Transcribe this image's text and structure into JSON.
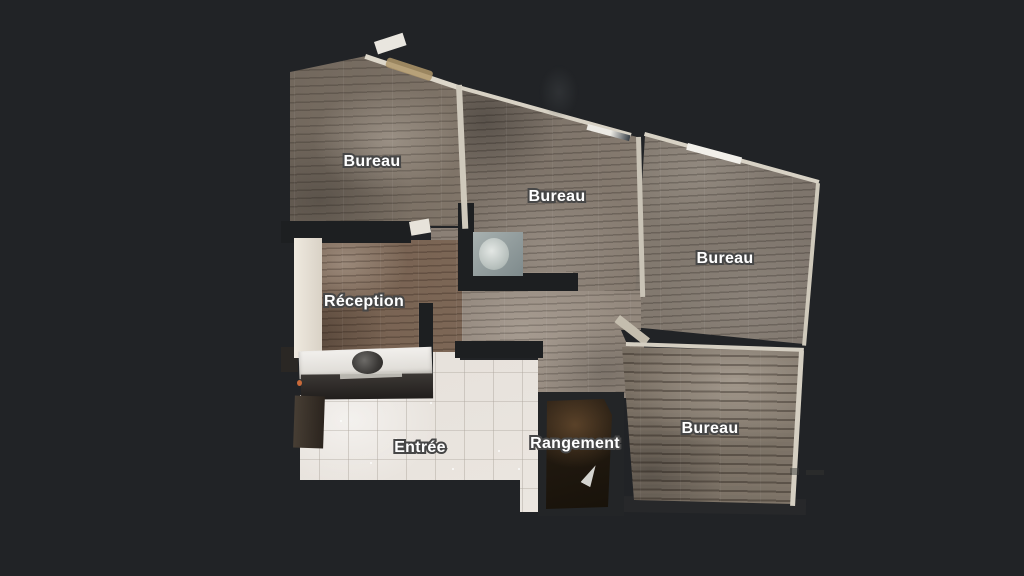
{
  "canvas": {
    "background_color": "#212326",
    "view": "floorplan-top-down"
  },
  "rooms": [
    {
      "id": "bureau-top-left",
      "label": "Bureau"
    },
    {
      "id": "bureau-center",
      "label": "Bureau"
    },
    {
      "id": "bureau-right",
      "label": "Bureau"
    },
    {
      "id": "reception",
      "label": "Réception"
    },
    {
      "id": "entree",
      "label": "Entrée"
    },
    {
      "id": "rangement",
      "label": "Rangement"
    },
    {
      "id": "bureau-bottom-right",
      "label": "Bureau"
    }
  ],
  "style": {
    "label_text_color": "#ffffff",
    "label_outline_color": "#474747",
    "floor_wood_color": "#7b7168",
    "floor_tile_color": "#ebe7e1",
    "wall_dark_color": "#1d1f21",
    "wall_light_color": "#d8d2c5"
  }
}
